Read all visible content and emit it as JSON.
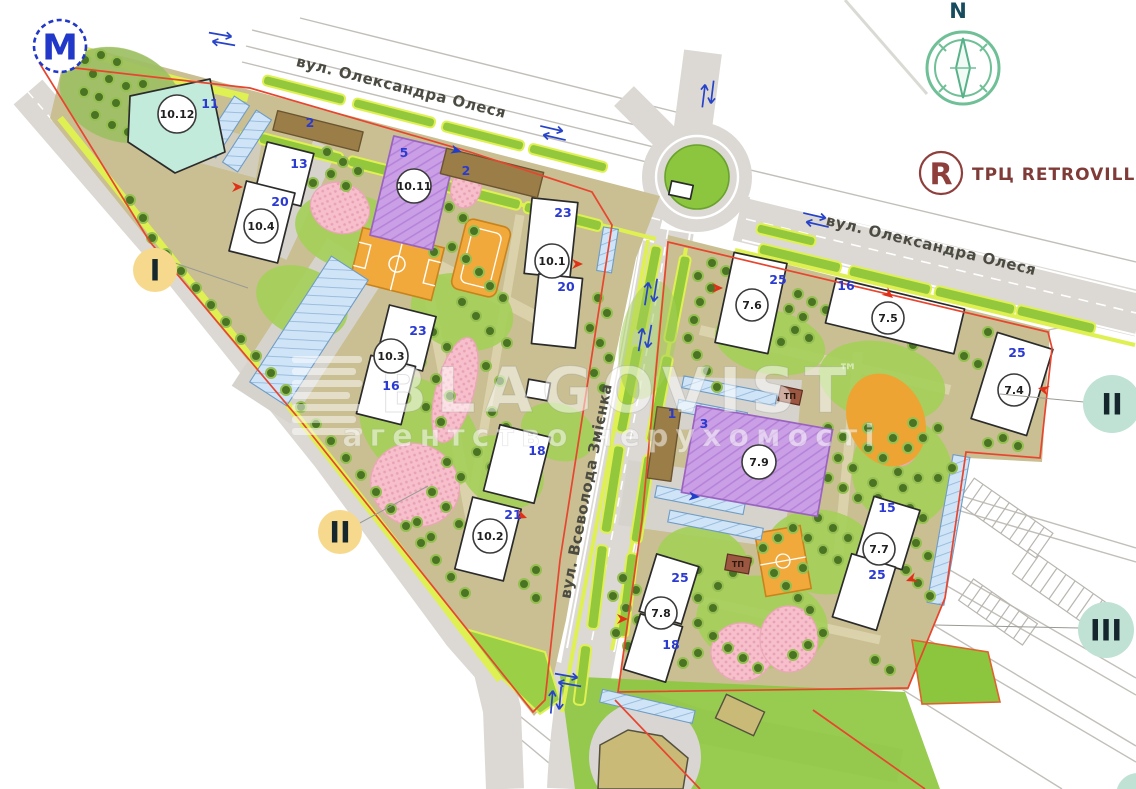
{
  "map": {
    "metro": {
      "letter": "М"
    },
    "compass": {
      "north_label": "N"
    },
    "retroville": {
      "letter": "R",
      "label": "ТРЦ RETROVILLE"
    },
    "streets": [
      {
        "name": "вул. Олександра Олеся"
      },
      {
        "name": "вул. Олександра Олеся"
      },
      {
        "name": "вул. Всеволода Змієнка"
      }
    ],
    "sections": [
      {
        "label": "I"
      },
      {
        "label": "II"
      },
      {
        "label": "II"
      },
      {
        "label": "III"
      }
    ],
    "buildings": [
      {
        "id": "10.12",
        "floors": [
          "11"
        ]
      },
      {
        "id": "10.4",
        "floors": [
          "13",
          "20"
        ]
      },
      {
        "id": "10.11",
        "floors": [
          "5"
        ]
      },
      {
        "id": "10.1",
        "floors": [
          "23",
          "20"
        ]
      },
      {
        "id": "10.3",
        "floors": [
          "23",
          "16"
        ]
      },
      {
        "id": "10.2",
        "floors": [
          "18",
          "21"
        ]
      },
      {
        "id": "7.6",
        "floors": [
          "25"
        ]
      },
      {
        "id": "7.5",
        "floors": [
          "16"
        ]
      },
      {
        "id": "7.4",
        "floors": [
          "25"
        ]
      },
      {
        "id": "7.9",
        "floors": [
          "3"
        ]
      },
      {
        "id": "7.7",
        "floors": [
          "15",
          "25"
        ]
      },
      {
        "id": "7.8",
        "floors": [
          "25",
          "18"
        ]
      }
    ],
    "annex_labels": [
      {
        "text": "2"
      },
      {
        "text": "2"
      },
      {
        "text": "1"
      }
    ],
    "utility_labels": [
      {
        "text": "ТП"
      },
      {
        "text": "ТП"
      }
    ],
    "watermark": {
      "brand": "BLAGOVIST",
      "tm": "™",
      "subtitle": "агентство нерухомості"
    },
    "colors": {
      "boundary_red": "#e8452f",
      "greenery": "#93c83d",
      "green_edge": "#dff052",
      "ground_khaki": "#c9bf92",
      "road_gray": "#dcd9d4",
      "parking_blue": "#cfe4f7",
      "building_purple": "#cb9fe6",
      "building_mint": "#c2ebdb",
      "court_orange": "#f2a93b",
      "playground_pink": "#f6bfcb",
      "section_yellow": "#f7d98e",
      "section_mint": "#bfe2d4",
      "metro_blue": "#2138c8",
      "retroville_maroon": "#8e3f3c",
      "compass_green": "#6fbf97",
      "floors_blue": "#2b3ad0"
    }
  }
}
